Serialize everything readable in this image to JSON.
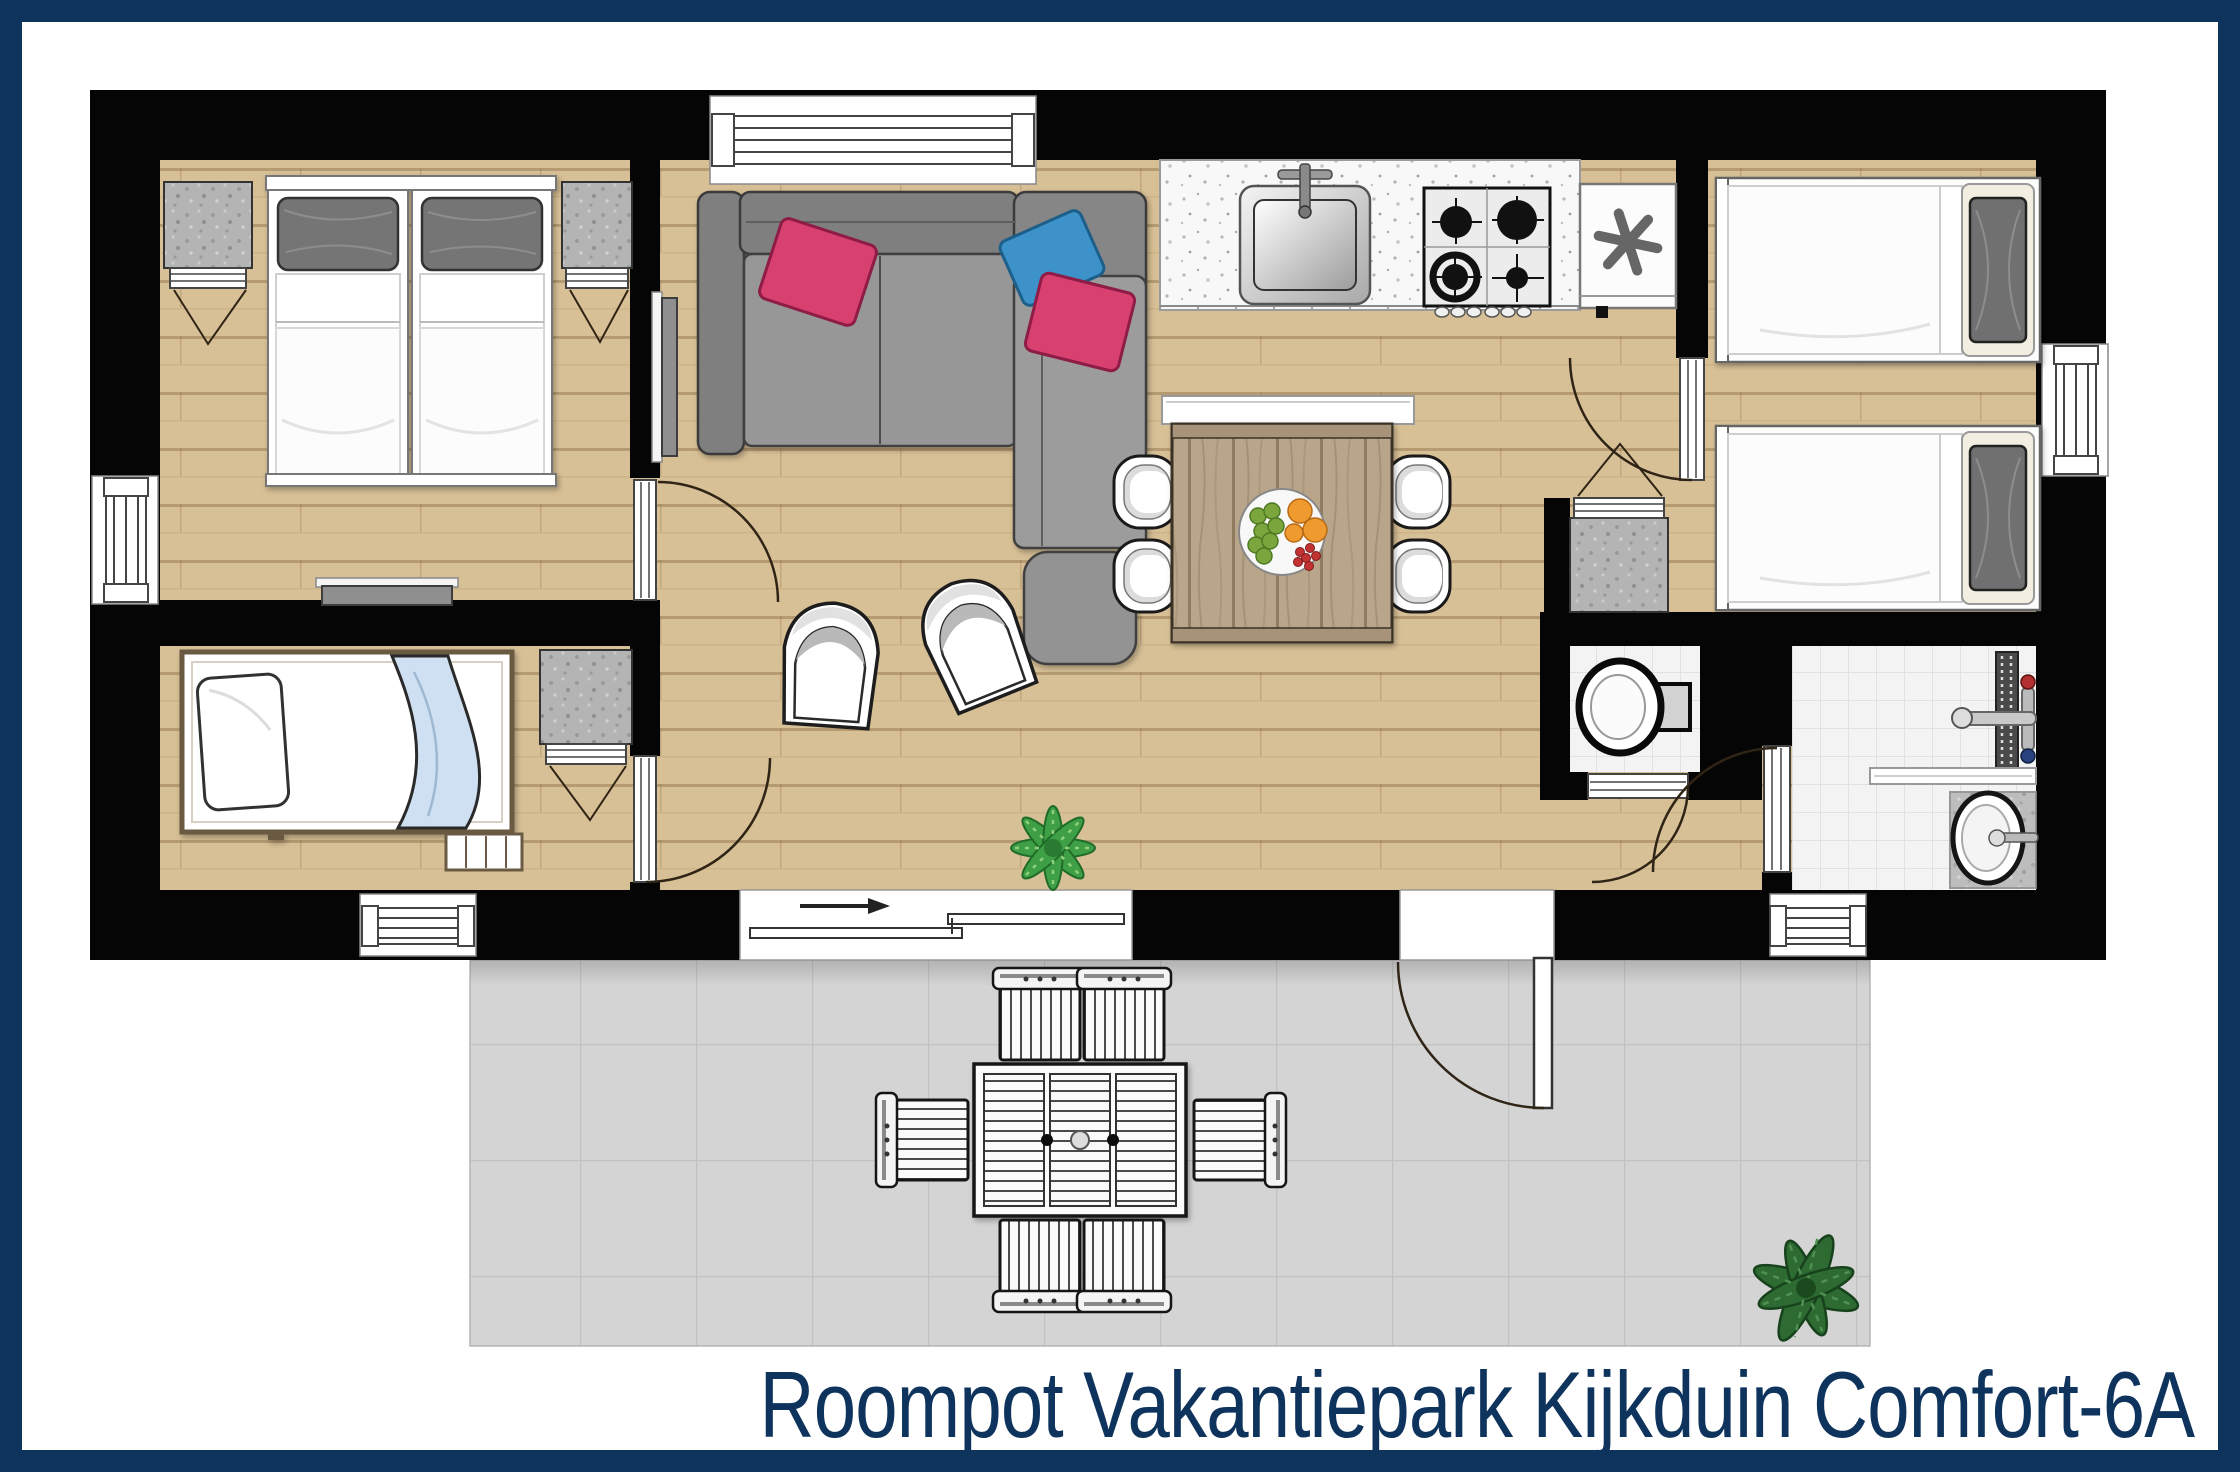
{
  "title": {
    "text": "Roompot Vakantiepark Kijkduin Comfort-6A"
  },
  "colors": {
    "frame_navy": "#0E335C",
    "title_text": "#0E335C",
    "walls": "#050505",
    "floor_wood": "#D8C096",
    "terrace_gray": "#D4D4D4",
    "bathroom_tiles": "#F3F3F3",
    "sofa_gray": "#8A8A8A",
    "pillow_pink": "#D84070",
    "pillow_blue": "#3E93C9",
    "blanket_blue": "#CFE0F2",
    "plant_green_living": "#3F9F46",
    "plant_green_terrace": "#2E6B33",
    "dining_table_wood": "#B9A68A"
  },
  "icons": [
    {
      "name": "freezer-asterisk-icon",
      "glyph": "✳"
    },
    {
      "name": "entrance-arrow-icon",
      "glyph": "→"
    },
    {
      "name": "plant-icon",
      "glyph": "❋"
    }
  ]
}
